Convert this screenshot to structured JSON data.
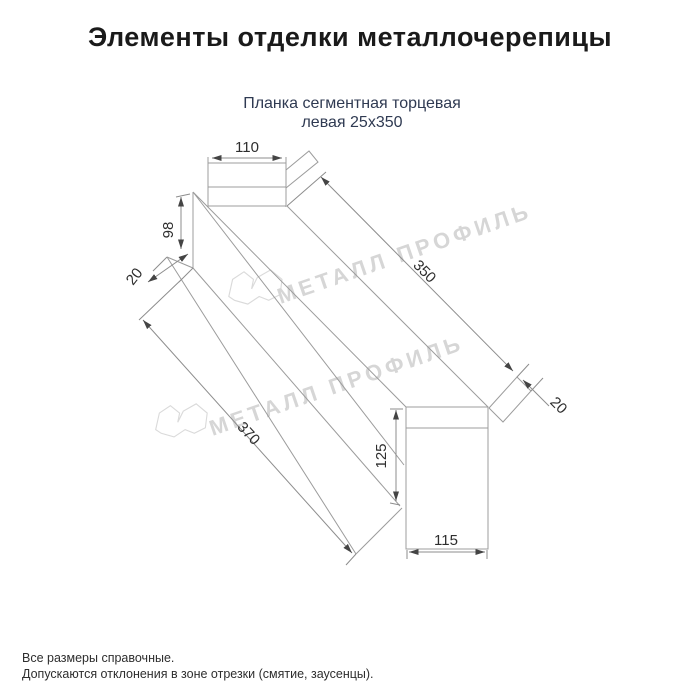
{
  "header": {
    "title": "Элементы отделки металлочерепицы",
    "subtitle_line1": "Планка сегментная торцевая",
    "subtitle_line2": "левая 25х350"
  },
  "drawing": {
    "product": "Планка сегментная торцевая левая 25х350",
    "dims": {
      "top_width": "110",
      "left_height": "98",
      "left_hem": "20",
      "side_length": "350",
      "right_hem": "20",
      "bottom_length": "370",
      "end_height": "125",
      "end_width": "115"
    }
  },
  "watermark": {
    "text": "МЕТАЛЛ ПРОФИЛЬ",
    "color": "#d6d6d6"
  },
  "footer": {
    "line1": "Все размеры справочные.",
    "line2": "Допускаются отклонения в зоне отрезки (смятие, заусенцы)."
  },
  "colors": {
    "title": "#1a1a1a",
    "subtitle": "#2f3a52",
    "drawing_line": "#9c9c9c",
    "dimension_text": "#2e2e2e",
    "background": "#ffffff"
  }
}
